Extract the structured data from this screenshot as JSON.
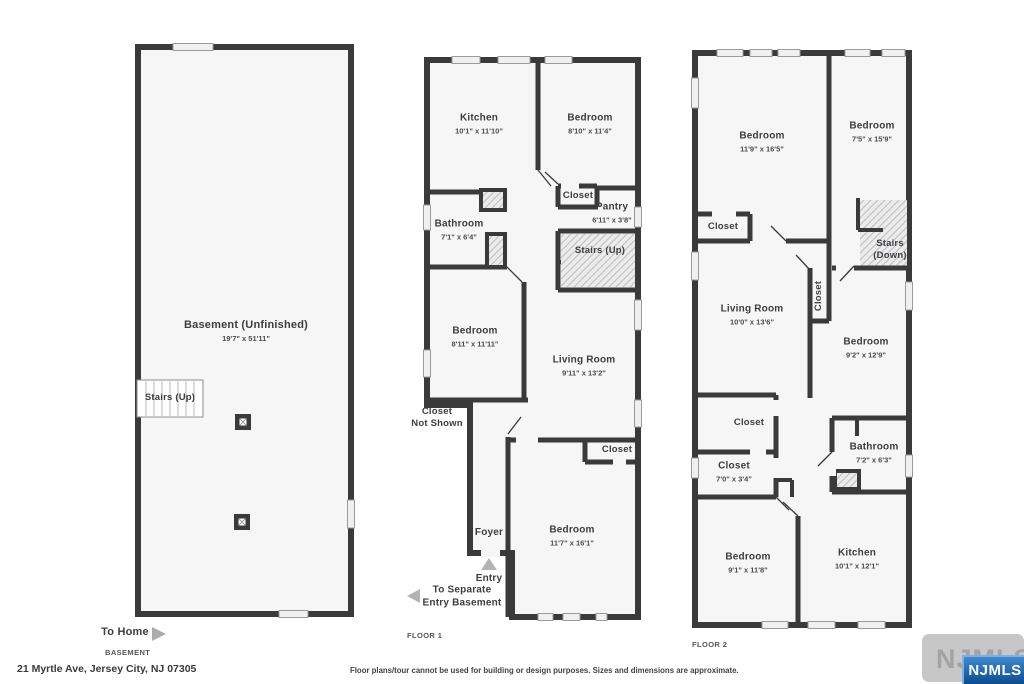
{
  "meta": {
    "address": "21 Myrtle Ave, Jersey City, NJ 07305",
    "disclaimer": "Floor plans/tour cannot be used for building or design purposes. Sizes and dimensions are approximate.",
    "watermark": "NJMLS",
    "watermark_badge": "NJMLS",
    "colors": {
      "wall": "#3a3a3a",
      "room_fill": "#f6f6f6",
      "badge_blue": "#0c4c8e"
    }
  },
  "basement": {
    "floor_label": "BASEMENT",
    "rooms": {
      "basement": {
        "name": "Basement (Unfinished)",
        "dims": "19'7\" x 51'11\""
      },
      "stairs": {
        "name": "Stairs (Up)"
      }
    },
    "annotations": {
      "to_home": "To Home"
    }
  },
  "floor1": {
    "floor_label": "FLOOR 1",
    "rooms": {
      "kitchen": {
        "name": "Kitchen",
        "dims": "10'1\" x 11'10\""
      },
      "bedroom_top": {
        "name": "Bedroom",
        "dims": "8'10\" x 11'4\""
      },
      "closet_top": {
        "name": "Closet"
      },
      "pantry": {
        "name": "Pantry",
        "dims": "6'11\" x 3'8\""
      },
      "bathroom": {
        "name": "Bathroom",
        "dims": "7'1\" x 6'4\""
      },
      "stairs": {
        "name": "Stairs (Up)"
      },
      "bedroom_mid": {
        "name": "Bedroom",
        "dims": "8'11\" x 11'11\""
      },
      "living_room": {
        "name": "Living Room",
        "dims": "9'11\" x 13'2\""
      },
      "closet_bottom": {
        "name": "Closet"
      },
      "foyer": {
        "name": "Foyer"
      },
      "bedroom_bottom": {
        "name": "Bedroom",
        "dims": "11'7\" x 16'1\""
      }
    },
    "annotations": {
      "closet_not_shown_1": "Closet",
      "closet_not_shown_2": "Not Shown",
      "entry": "Entry",
      "separate_1": "To Separate",
      "separate_2": "Entry Basement"
    }
  },
  "floor2": {
    "floor_label": "FLOOR 2",
    "rooms": {
      "bedroom_tl": {
        "name": "Bedroom",
        "dims": "11'9\" x 16'5\""
      },
      "bedroom_tr": {
        "name": "Bedroom",
        "dims": "7'5\" x 15'9\""
      },
      "closet_top": {
        "name": "Closet"
      },
      "stairs_1": "Stairs",
      "stairs_2": "(Down)",
      "living_room": {
        "name": "Living Room",
        "dims": "10'0\" x 13'6\""
      },
      "closet_mid": {
        "name": "Closet"
      },
      "bedroom_right": {
        "name": "Bedroom",
        "dims": "9'2\" x 12'9\""
      },
      "closet_a": {
        "name": "Closet"
      },
      "closet_b": {
        "name": "Closet",
        "dims": "7'0\" x 3'4\""
      },
      "bathroom": {
        "name": "Bathroom",
        "dims": "7'2\" x 6'3\""
      },
      "bedroom_bottom": {
        "name": "Bedroom",
        "dims": "9'1\" x 11'8\""
      },
      "kitchen": {
        "name": "Kitchen",
        "dims": "10'1\" x 12'1\""
      }
    }
  }
}
